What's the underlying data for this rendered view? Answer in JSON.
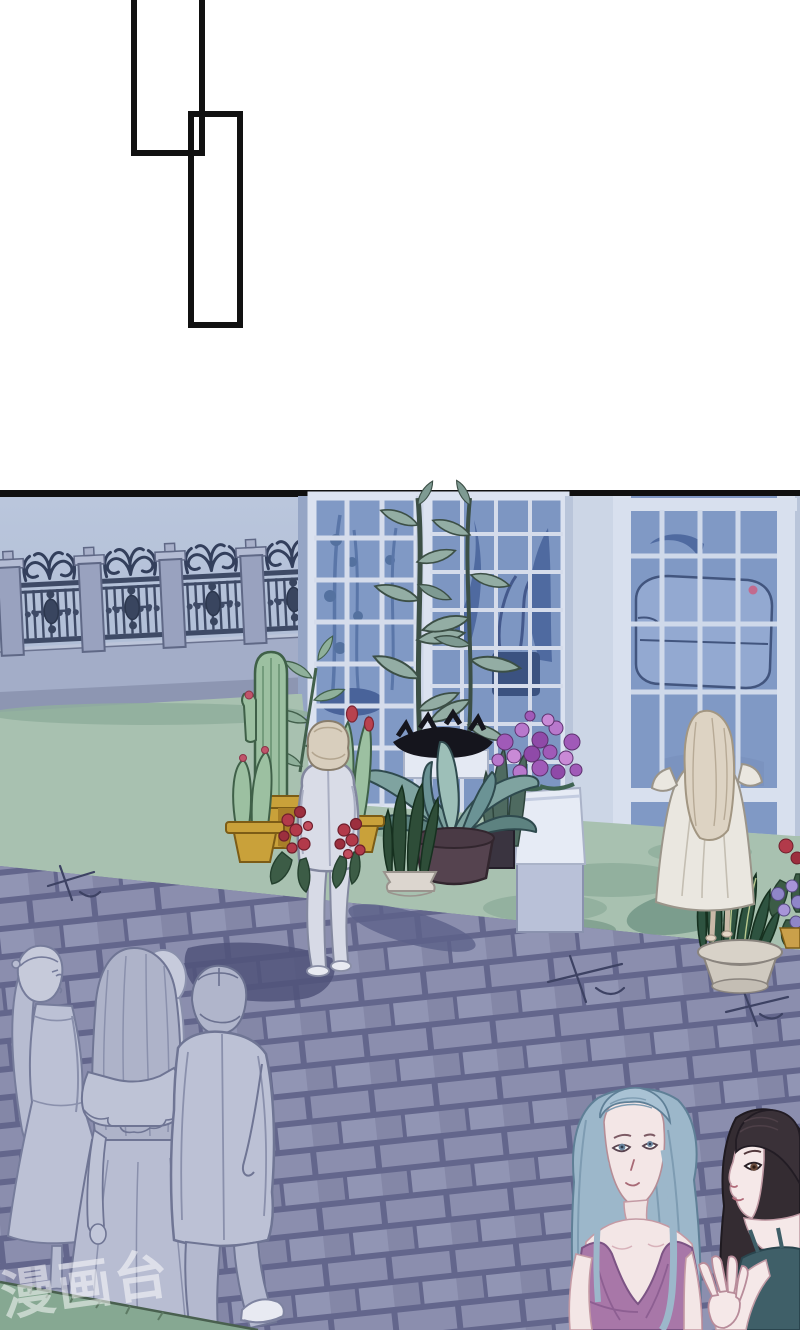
{
  "page": {
    "type": "manhua-comic-page",
    "background": "#ffffff",
    "panel_border_color": "#101010"
  },
  "bubbles": {
    "bubble1_text": "",
    "bubble2_text": ""
  },
  "watermark": {
    "text": "漫画台",
    "color": "#ffffff"
  },
  "scene": {
    "setting": "night garden courtyard outside a glass conservatory",
    "elements": [
      "ornate wrought-iron fence on low wall",
      "conservatory glass windows and doors",
      "sofa silhouette behind glass",
      "tall twin-stem plant",
      "potted cacti with red buds in gold pots",
      "red rose bushes",
      "large blue-green leafy plant in dark pot",
      "purple flowers in white planter box",
      "snake plant in pale pot",
      "right-edge flower cluster",
      "green lawn with shadows",
      "purple brick path with crack marks",
      "grass corner bottom-left"
    ],
    "characters": [
      {
        "name": "man-standing",
        "description": "man in pale suit seen from behind among the pots"
      },
      {
        "name": "woman-white-dress",
        "description": "long-haired woman in white off-shoulder dress facing the conservatory"
      },
      {
        "name": "walking-woman-ponytail",
        "description": "monochrome woman with ponytail walking away"
      },
      {
        "name": "walking-woman-ruffle",
        "description": "monochrome woman with long hair and ruffle top walking away"
      },
      {
        "name": "walking-man-suit",
        "description": "monochrome man in suit walking away"
      },
      {
        "name": "woman-blue-hair",
        "description": "woman with slicked blue-grey hair in purple v-neck top"
      },
      {
        "name": "woman-dark-hair",
        "description": "dark-haired woman in teal top raising one hand"
      }
    ],
    "palette": {
      "wall": "#b3c1d8",
      "window_frame": "#d8e0ee",
      "glass": "#8099c5",
      "glass_silhouette": "#54719f",
      "fence_iron": "#3e4a66",
      "fence_pillar": "#99a2bf",
      "lawn": "#a8c1b0",
      "lawn_shadow": "#8fae9c",
      "grass_corner": "#86a892",
      "brick": "#8b8eae",
      "mortar": "#63668c",
      "path_shadow": "#5d618a",
      "pot_gold": "#c9a13a",
      "cactus": "#9cc0a1",
      "big_leaf": "#7fa3a0",
      "dark_pot": "#55434f",
      "purple_flower": "#a05ab8",
      "planter_white": "#e6ebf5",
      "suit_grey": "#d9dce7",
      "hair_blonde": "#d8cebd",
      "dress_white": "#eae7e0",
      "mono_figure": "#b8bdd2",
      "mono_line": "#6f7594",
      "hair_blue": "#9cb7ca",
      "top_purple": "#a877a8",
      "hair_dark": "#342c32",
      "top_teal": "#3f5f68",
      "skin": "#f3e6e6"
    }
  }
}
